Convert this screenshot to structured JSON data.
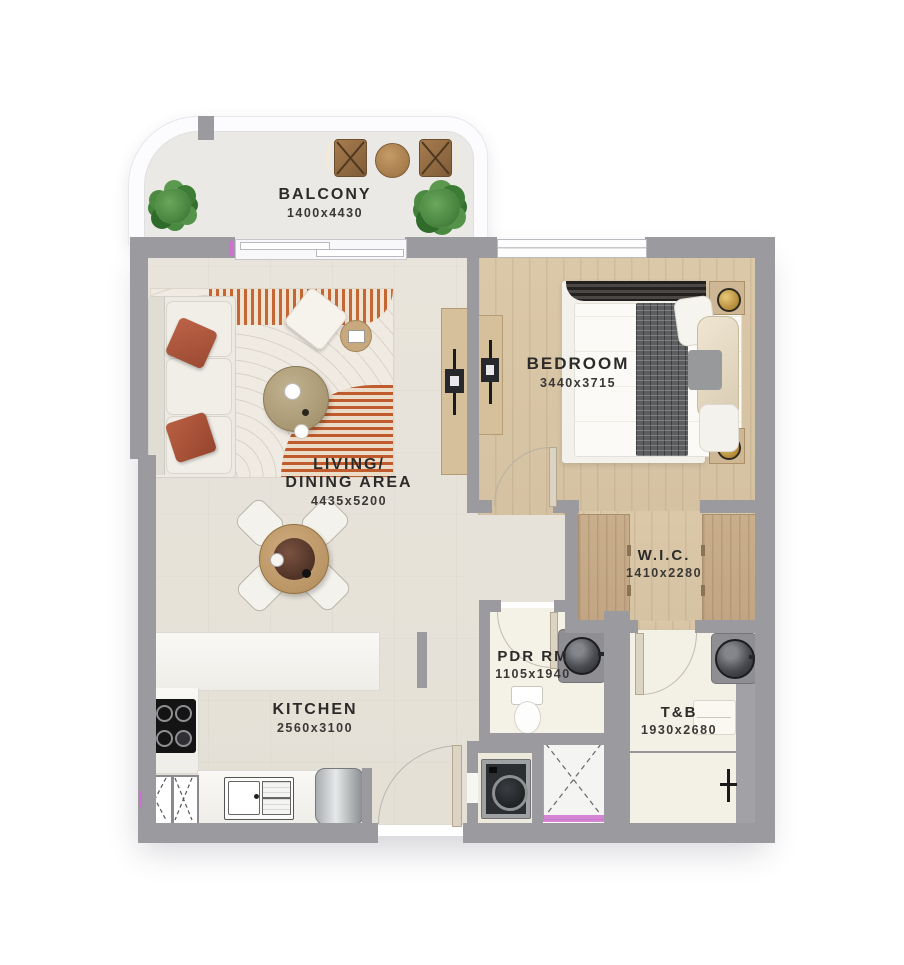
{
  "plan": {
    "type": "apartment-floor-plan",
    "rooms": {
      "balcony": {
        "name": "BALCONY",
        "dims": "1400x4430"
      },
      "living": {
        "name_line1": "LIVING/",
        "name_line2": "DINING AREA",
        "dims": "4435x5200"
      },
      "bedroom": {
        "name": "BEDROOM",
        "dims": "3440x3715"
      },
      "wic": {
        "name": "W.I.C.",
        "dims": "1410x2280"
      },
      "pdr": {
        "name": "PDR RM",
        "dims": "1105x1940"
      },
      "tb": {
        "name": "T&B",
        "dims": "1930x2680"
      },
      "kitchen": {
        "name": "KITCHEN",
        "dims": "2560x3100"
      }
    },
    "colors": {
      "wall": "#9b9a9e",
      "living_floor": "#e7e3da",
      "wood_floor": "#d9c6a7",
      "wardrobe": "#c8ad8b",
      "bath_floor": "#f3f0e5",
      "balcony_floor": "#eae9e6",
      "accent_magenta": "#cf6fcf",
      "rug_orange": "#c05c28",
      "pillow_terracotta": "#b05a40",
      "label_text": "#2d2b29"
    }
  }
}
